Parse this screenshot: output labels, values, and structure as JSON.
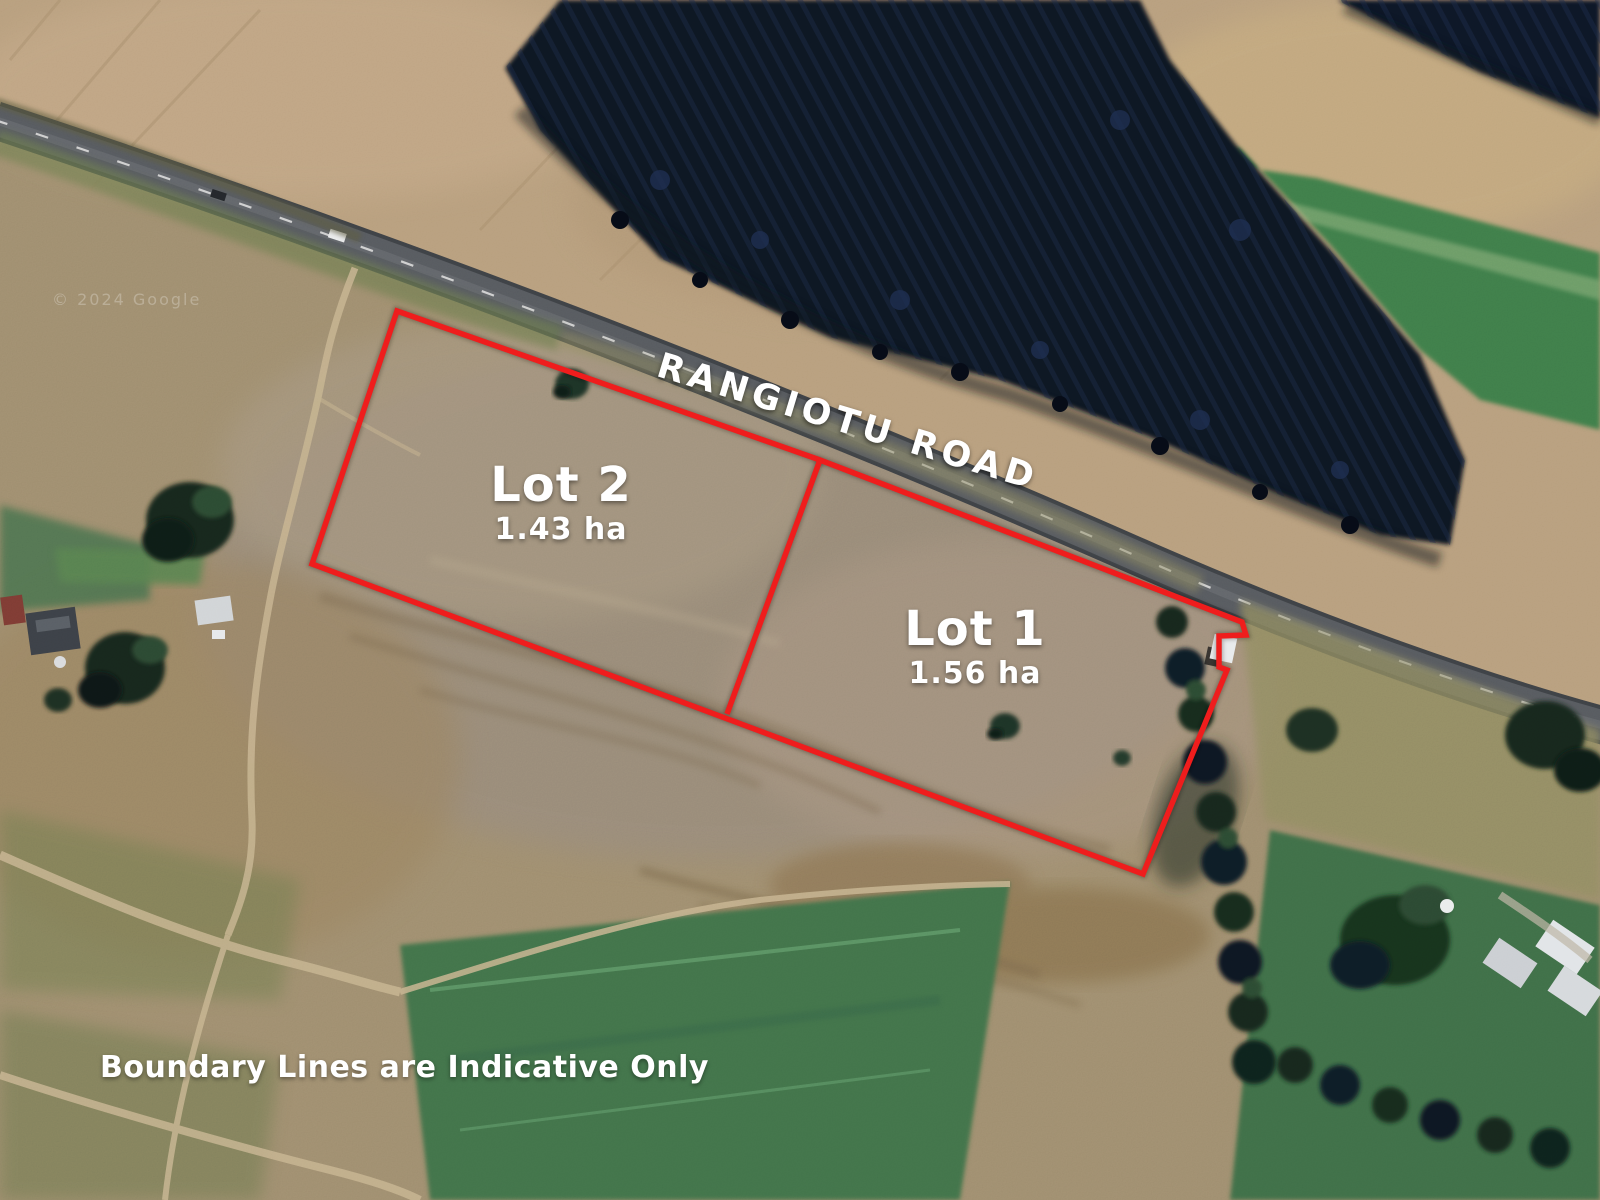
{
  "map": {
    "road_label": "RANGIOTU ROAD",
    "disclaimer": "Boundary Lines are Indicative Only",
    "watermark": "© 2024 Google",
    "lots": [
      {
        "name": "Lot 1",
        "area": "1.56 ha"
      },
      {
        "name": "Lot 2",
        "area": "1.43 ha"
      }
    ],
    "colors": {
      "boundary": "#ee1b1b",
      "label_text": "#ffffff"
    }
  }
}
